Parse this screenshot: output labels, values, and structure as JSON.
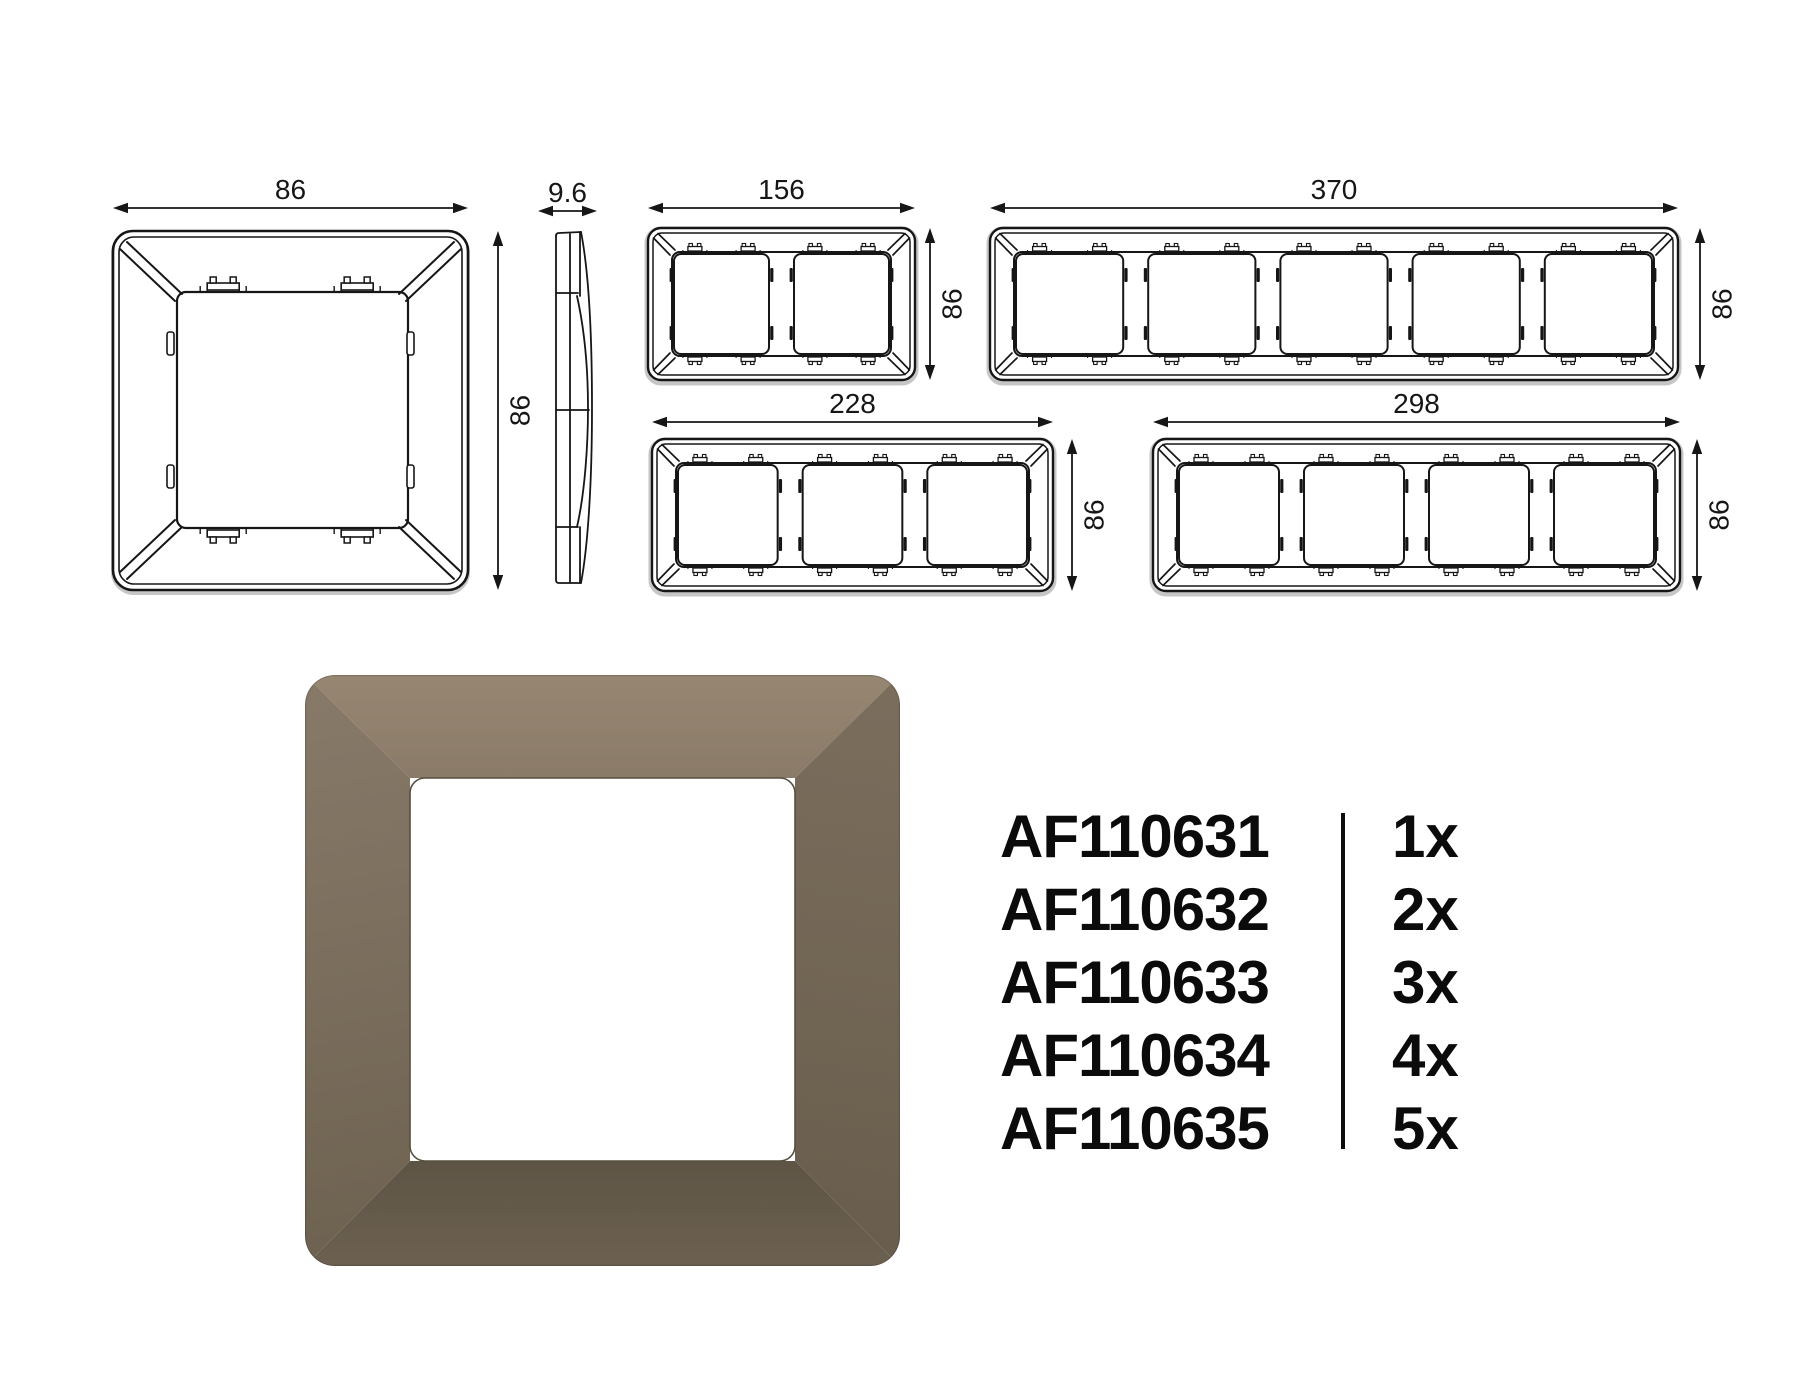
{
  "technical_drawings": {
    "front_view": {
      "name": "1-gang frame back view",
      "width_label": "86",
      "height_label": "86"
    },
    "side_view": {
      "name": "frame side profile",
      "thickness_label": "9.6"
    },
    "multi_frames": [
      {
        "name": "2-gang frame back view",
        "modules": 2,
        "width_label": "156",
        "height_label": "86"
      },
      {
        "name": "5-gang frame back view",
        "modules": 5,
        "width_label": "370",
        "height_label": "86"
      },
      {
        "name": "3-gang frame back view",
        "modules": 3,
        "width_label": "228",
        "height_label": "86"
      },
      {
        "name": "4-gang frame back view",
        "modules": 4,
        "width_label": "298",
        "height_label": "86"
      }
    ]
  },
  "product_render": {
    "name": "1-gang frame front render, mocha brown",
    "colors": {
      "face_top_start": "#968672",
      "face_top_end": "#8a7b68",
      "face_left_start": "#877968",
      "face_left_end": "#6e6251",
      "face_right_start": "#7b6d5c",
      "face_right_end": "#695e4d",
      "face_bottom_start": "#5e5445",
      "face_bottom_end": "#6c6151",
      "opening": "#ffffff",
      "rim": "#57503f"
    }
  },
  "product_table": {
    "rows": [
      {
        "code": "AF110631",
        "quantity": "1x"
      },
      {
        "code": "AF110632",
        "quantity": "2x"
      },
      {
        "code": "AF110633",
        "quantity": "3x"
      },
      {
        "code": "AF110634",
        "quantity": "4x"
      },
      {
        "code": "AF110635",
        "quantity": "5x"
      }
    ]
  },
  "drawing_style": {
    "line_color": "#161616",
    "shadow_color": "#c6c6c6"
  }
}
